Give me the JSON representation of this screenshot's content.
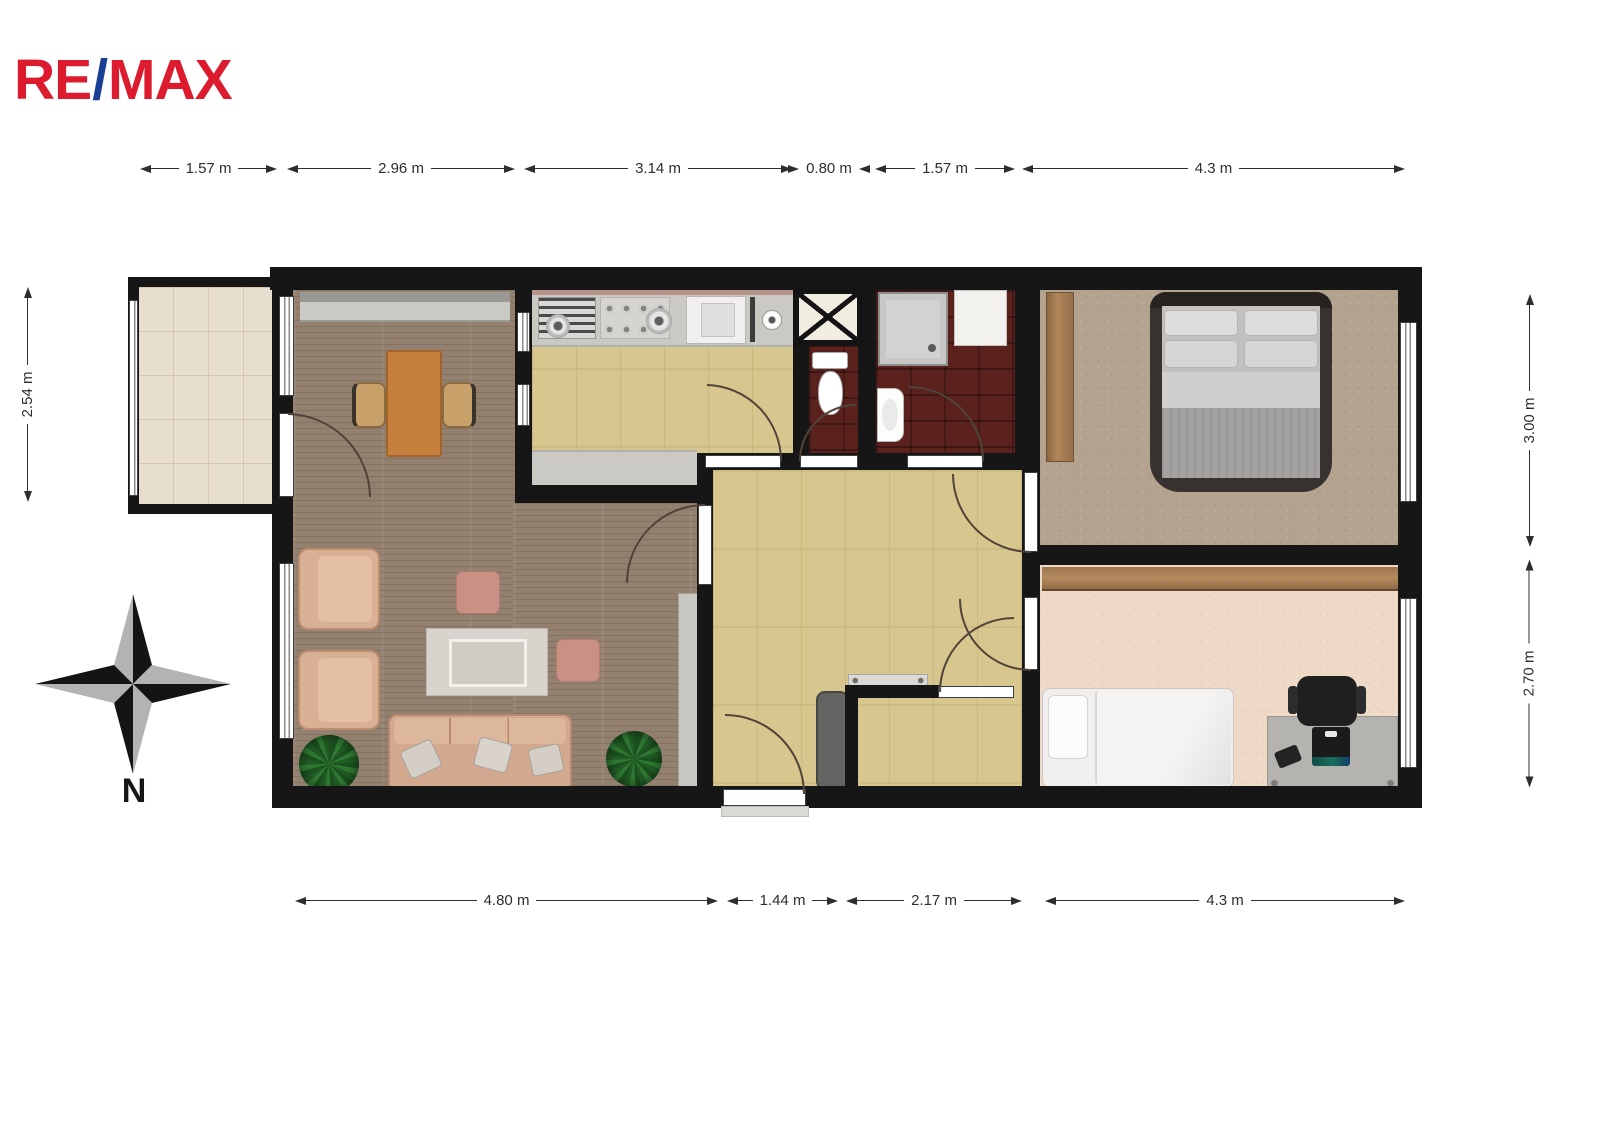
{
  "logo": {
    "part1": "RE",
    "slash": "/",
    "part2": "MAX"
  },
  "compass": {
    "north_label": "N"
  },
  "dimensions": {
    "top": [
      {
        "label": "1.57 m"
      },
      {
        "label": "2.96 m"
      },
      {
        "label": "3.14 m"
      },
      {
        "label": "0.80 m"
      },
      {
        "label": "1.57 m"
      },
      {
        "label": "4.3 m"
      }
    ],
    "bottom": [
      {
        "label": "4.80 m"
      },
      {
        "label": "1.44 m"
      },
      {
        "label": "2.17 m"
      },
      {
        "label": "4.3 m"
      }
    ],
    "left": [
      {
        "label": "2.54 m"
      }
    ],
    "right": [
      {
        "label": "3.00 m"
      },
      {
        "label": "2.70 m"
      }
    ]
  },
  "colors": {
    "logo_red": "#dc1c2e",
    "logo_blue": "#1b3f94",
    "wall": "#161616",
    "living_floor_wood": "#94806f",
    "light_wood_floor": "#d7c78f",
    "bathroom_tile": "#5a211d",
    "bedroom_carpet": "#b2a28e",
    "second_bedroom_carpet": "#eed9c6",
    "balcony_tile": "#e8decd",
    "counter_gray": "#c9c7c2",
    "wardrobe_wood": "#a57c56",
    "dining_table": "#c4803c",
    "sofa_tan": "#d5ab90",
    "pouf_pink": "#c98e81",
    "plant_green": "#2e7d32"
  }
}
